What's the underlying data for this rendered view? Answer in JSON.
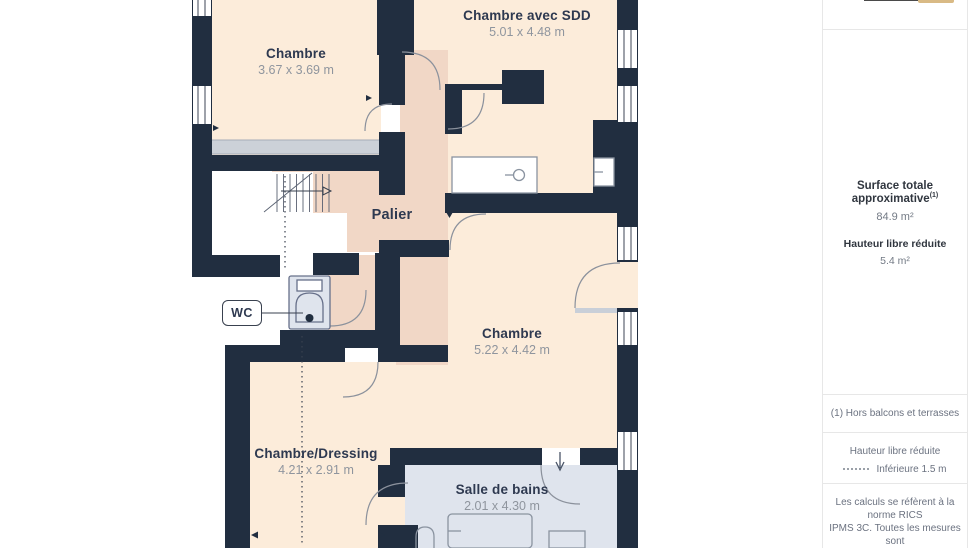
{
  "plan": {
    "rooms": [
      {
        "name": "Chambre",
        "dims": "3.67 x 3.69 m"
      },
      {
        "name": "Chambre avec SDD",
        "dims": "5.01 x 4.48 m"
      },
      {
        "name": "Palier",
        "dims": ""
      },
      {
        "name": "Chambre",
        "dims": "5.22 x 4.42 m"
      },
      {
        "name": "Chambre/Dressing",
        "dims": "4.21 x 2.91 m"
      },
      {
        "name": "Salle de bains",
        "dims": "2.01 x 4.30 m"
      }
    ],
    "wc_label": "WC",
    "colors": {
      "wall": "#212e40",
      "room_fill": "#fcecda",
      "landing_fill": "#f1d7c6",
      "wet_room_fill": "#dfe4ed",
      "radiator_gray": "#ccd1d8",
      "accent_gold": "#d9ba85"
    }
  },
  "sidebar": {
    "surface_title": "Surface totale approximative",
    "surface_sup": "(1)",
    "surface_value": "84.9 m²",
    "height_title": "Hauteur libre réduite",
    "height_value": "5.4 m²",
    "footnote1": "(1) Hors balcons et terrasses",
    "legend_title": "Hauteur libre réduite",
    "legend_value": "Inférieure 1.5 m",
    "note_line1": "Les calculs se réfèrent à la norme RICS",
    "note_line2": "IPMS 3C. Toutes les mesures sont"
  }
}
